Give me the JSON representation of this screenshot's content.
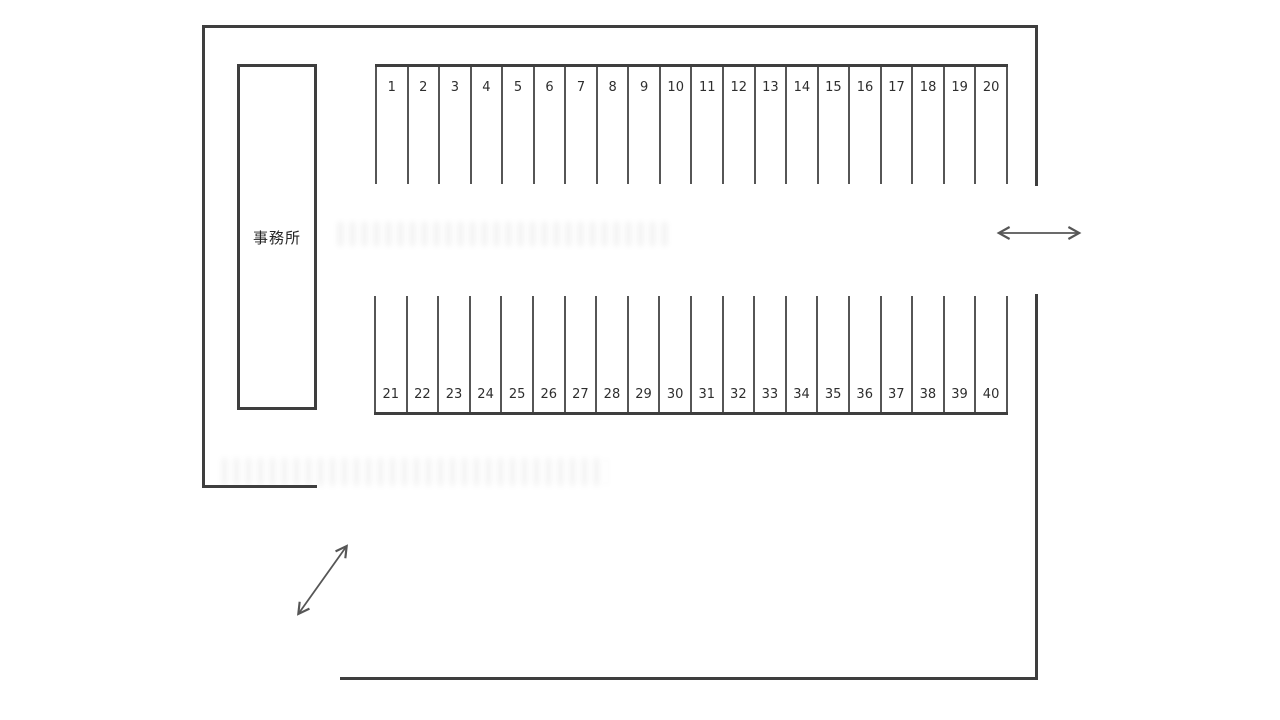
{
  "page": {
    "description_colors": {
      "background": "#ffffff",
      "line": "#3e3e3e",
      "text": "#2e2e2e"
    }
  },
  "office": {
    "label": "事務所"
  },
  "parking_rows": {
    "top": {
      "numbers": [
        "1",
        "2",
        "3",
        "4",
        "5",
        "6",
        "7",
        "8",
        "9",
        "10",
        "11",
        "12",
        "13",
        "14",
        "15",
        "16",
        "17",
        "18",
        "19",
        "20"
      ]
    },
    "bottom": {
      "numbers": [
        "21",
        "22",
        "23",
        "24",
        "25",
        "26",
        "27",
        "28",
        "29",
        "30",
        "31",
        "32",
        "33",
        "34",
        "35",
        "36",
        "37",
        "38",
        "39",
        "40"
      ]
    }
  },
  "arrows": {
    "right_entrance_icon": "double-arrow-horizontal",
    "bottom_left_entrance_icon": "double-arrow-diagonal"
  }
}
